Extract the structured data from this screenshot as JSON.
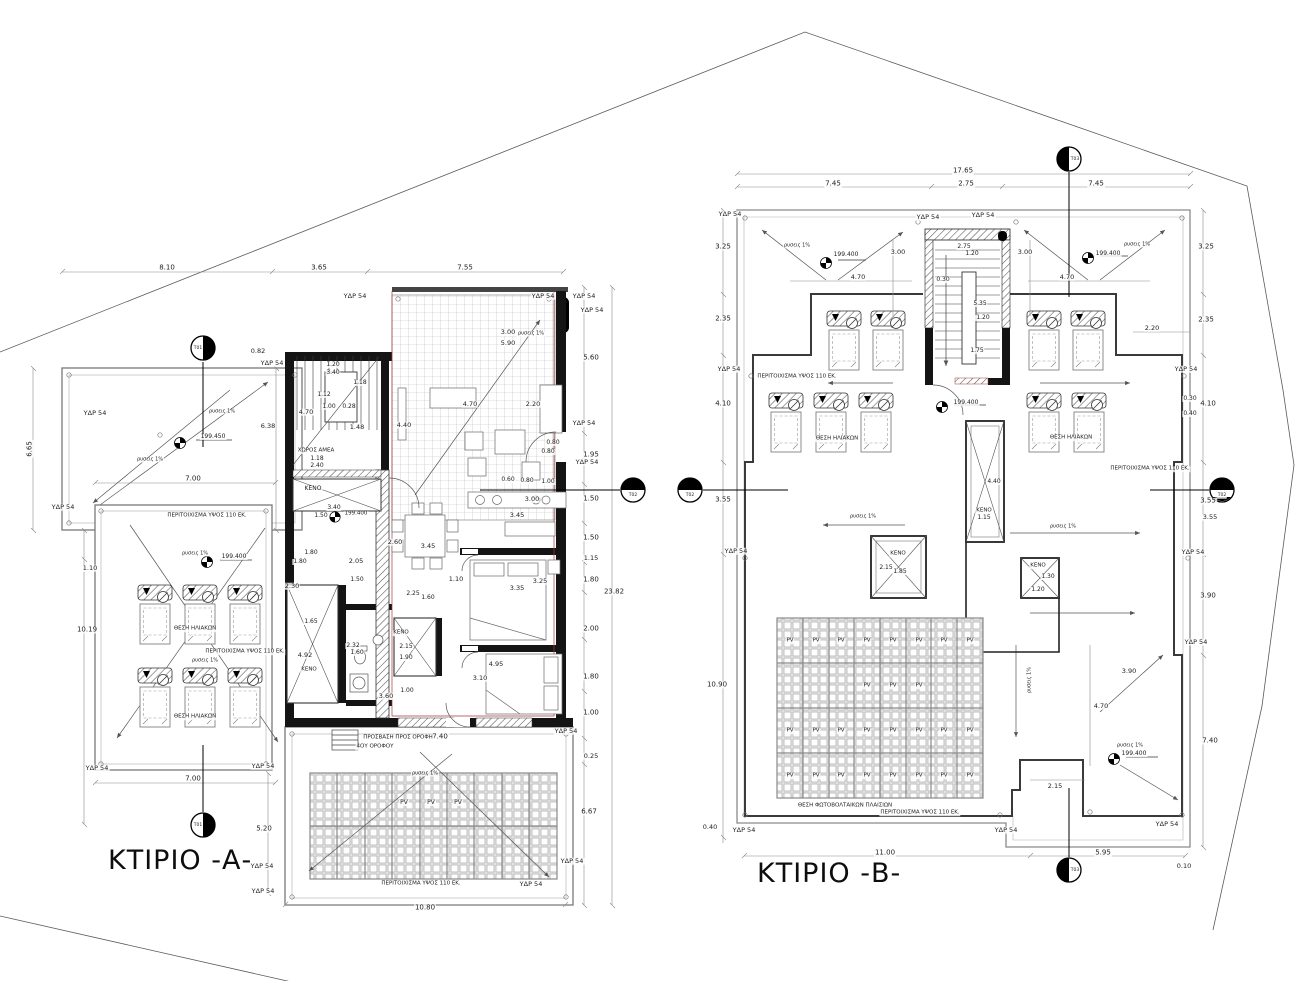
{
  "buildings": {
    "a": {
      "title": "ΚΤΙΡΙΟ -Α-"
    },
    "b": {
      "title": "ΚΤΙΡΙΟ -Β-"
    }
  },
  "colors": {
    "wall": "#141414",
    "red_line": "#a83a3a",
    "dim": "#444444"
  },
  "labels": [
    {
      "t": "8.10",
      "x": 167,
      "y": 268
    },
    {
      "t": "3.65",
      "x": 319,
      "y": 268
    },
    {
      "t": "7.55",
      "x": 465,
      "y": 268
    },
    {
      "t": "ΥΔΡ 54",
      "x": 355,
      "y": 296,
      "s": 6.5
    },
    {
      "t": "ΥΔΡ 54",
      "x": 543,
      "y": 296,
      "s": 6.5
    },
    {
      "t": "ΥΔΡ 54",
      "x": 584,
      "y": 296,
      "s": 6.5
    },
    {
      "t": "ΥΔΡ 54",
      "x": 592,
      "y": 310,
      "s": 6.5
    },
    {
      "t": "ΥΔΡ 54",
      "x": 584,
      "y": 423,
      "s": 6.5
    },
    {
      "t": "ΥΔΡ 54",
      "x": 587,
      "y": 462,
      "s": 6.5
    },
    {
      "t": "3.00",
      "x": 508,
      "y": 332,
      "s": 6.5
    },
    {
      "t": "5.90",
      "x": 508,
      "y": 343,
      "s": 6.5
    },
    {
      "t": "ρυσεις 1%",
      "x": 531,
      "y": 334,
      "s": 5
    },
    {
      "t": "5.60",
      "x": 591,
      "y": 358
    },
    {
      "t": "0.82",
      "x": 258,
      "y": 351,
      "s": 6.5
    },
    {
      "t": "ΥΔΡ 54",
      "x": 272,
      "y": 363,
      "s": 6.5
    },
    {
      "t": "Τ01",
      "x": 198,
      "y": 349,
      "s": 4.5
    },
    {
      "t": "Τ01",
      "x": 198,
      "y": 826,
      "s": 4.5
    },
    {
      "t": "ΥΔΡ 54",
      "x": 95,
      "y": 413,
      "s": 6.5
    },
    {
      "t": "ρυσεις 1%",
      "x": 222,
      "y": 412,
      "s": 5
    },
    {
      "t": "ρυσεις 1%",
      "x": 150,
      "y": 460,
      "s": 5
    },
    {
      "t": "199.450",
      "x": 213,
      "y": 437,
      "s": 6
    },
    {
      "t": "6.65",
      "x": 30,
      "y": 449,
      "r": -90
    },
    {
      "t": "6.38",
      "x": 268,
      "y": 426,
      "s": 6.5
    },
    {
      "t": "7.00",
      "x": 193,
      "y": 479
    },
    {
      "t": "7.00",
      "x": 193,
      "y": 779
    },
    {
      "t": "ΥΔΡ 54",
      "x": 63,
      "y": 507,
      "s": 6.5
    },
    {
      "t": "ΥΔΡ 54",
      "x": 97,
      "y": 768,
      "s": 6.5
    },
    {
      "t": "4.70",
      "x": 306,
      "y": 412,
      "s": 6.5
    },
    {
      "t": "1.12",
      "x": 324,
      "y": 395,
      "s": 6
    },
    {
      "t": "1.00",
      "x": 329,
      "y": 407,
      "s": 6
    },
    {
      "t": "0.28",
      "x": 349,
      "y": 407,
      "s": 6
    },
    {
      "t": "1.48",
      "x": 357,
      "y": 427,
      "s": 6.5
    },
    {
      "t": "1.20",
      "x": 333,
      "y": 365,
      "s": 6
    },
    {
      "t": "3.40",
      "x": 333,
      "y": 373,
      "s": 6
    },
    {
      "t": "1.18",
      "x": 360,
      "y": 383,
      "s": 6
    },
    {
      "t": "ΧΩΡΟΣ ΑΜΕΑ",
      "x": 316,
      "y": 451,
      "s": 5.5
    },
    {
      "t": "1.18",
      "x": 317,
      "y": 459,
      "s": 6
    },
    {
      "t": "2.40",
      "x": 317,
      "y": 466,
      "s": 6
    },
    {
      "t": "ΚΕΝΟ",
      "x": 313,
      "y": 489,
      "s": 6
    },
    {
      "t": "3.40",
      "x": 334,
      "y": 508,
      "s": 6
    },
    {
      "t": "1.50",
      "x": 321,
      "y": 516,
      "s": 6
    },
    {
      "t": "199.400",
      "x": 356,
      "y": 514,
      "s": 5.5
    },
    {
      "t": "4.70",
      "x": 470,
      "y": 404,
      "s": 6.5
    },
    {
      "t": "4.40",
      "x": 404,
      "y": 425,
      "s": 6.5
    },
    {
      "t": "2.20",
      "x": 533,
      "y": 404,
      "s": 6.5
    },
    {
      "t": "0.80",
      "x": 553,
      "y": 443,
      "s": 6
    },
    {
      "t": "0.80",
      "x": 548,
      "y": 452,
      "s": 6
    },
    {
      "t": "1.95",
      "x": 591,
      "y": 455
    },
    {
      "t": "0.60",
      "x": 508,
      "y": 480,
      "s": 6
    },
    {
      "t": "0.80",
      "x": 527,
      "y": 481,
      "s": 6
    },
    {
      "t": "1.00",
      "x": 548,
      "y": 482,
      "s": 6
    },
    {
      "t": "3.00",
      "x": 532,
      "y": 499,
      "s": 6.5
    },
    {
      "t": "1.50",
      "x": 591,
      "y": 499
    },
    {
      "t": "3.45",
      "x": 517,
      "y": 515,
      "s": 6.5
    },
    {
      "t": "3.45",
      "x": 428,
      "y": 546,
      "s": 6.5
    },
    {
      "t": "2.60",
      "x": 395,
      "y": 542,
      "s": 6.5
    },
    {
      "t": "1.80",
      "x": 311,
      "y": 553,
      "s": 6
    },
    {
      "t": "1.80",
      "x": 300,
      "y": 562,
      "s": 6
    },
    {
      "t": "2.05",
      "x": 356,
      "y": 561,
      "s": 6.5
    },
    {
      "t": "2.30",
      "x": 292,
      "y": 586,
      "s": 6.5
    },
    {
      "t": "1.50",
      "x": 357,
      "y": 580,
      "s": 6
    },
    {
      "t": "1.10",
      "x": 456,
      "y": 579,
      "s": 6.5
    },
    {
      "t": "3.35",
      "x": 517,
      "y": 588,
      "s": 6.5
    },
    {
      "t": "3.25",
      "x": 540,
      "y": 581,
      "s": 6.5
    },
    {
      "t": "2.25",
      "x": 413,
      "y": 594,
      "s": 6
    },
    {
      "t": "1.60",
      "x": 428,
      "y": 598,
      "s": 6
    },
    {
      "t": "ΚΕΝΟ",
      "x": 401,
      "y": 633,
      "s": 5.5
    },
    {
      "t": "2.15",
      "x": 406,
      "y": 647,
      "s": 6
    },
    {
      "t": "1.90",
      "x": 406,
      "y": 658,
      "s": 6
    },
    {
      "t": "1.65",
      "x": 311,
      "y": 622,
      "s": 6
    },
    {
      "t": "4.92",
      "x": 305,
      "y": 655,
      "s": 6.5
    },
    {
      "t": "ΚΕΝΟ",
      "x": 309,
      "y": 670,
      "s": 5.5
    },
    {
      "t": "2.32",
      "x": 353,
      "y": 646,
      "s": 6
    },
    {
      "t": "1.60",
      "x": 357,
      "y": 653,
      "s": 6
    },
    {
      "t": "3.60",
      "x": 386,
      "y": 696,
      "s": 6.5
    },
    {
      "t": "1.00",
      "x": 407,
      "y": 691,
      "s": 6
    },
    {
      "t": "4.95",
      "x": 496,
      "y": 664,
      "s": 6.5
    },
    {
      "t": "3.10",
      "x": 480,
      "y": 678,
      "s": 6.5
    },
    {
      "t": "1.50",
      "x": 591,
      "y": 538
    },
    {
      "t": "1.15",
      "x": 591,
      "y": 558,
      "s": 6.5
    },
    {
      "t": "1.80",
      "x": 591,
      "y": 580
    },
    {
      "t": "2.00",
      "x": 591,
      "y": 629
    },
    {
      "t": "1.80",
      "x": 591,
      "y": 677
    },
    {
      "t": "1.00",
      "x": 591,
      "y": 713
    },
    {
      "t": "23.82",
      "x": 614,
      "y": 592
    },
    {
      "t": "0.25",
      "x": 591,
      "y": 756,
      "s": 6.5
    },
    {
      "t": "6.67",
      "x": 589,
      "y": 812
    },
    {
      "t": "ΥΔΡ 54",
      "x": 566,
      "y": 731,
      "s": 6.5
    },
    {
      "t": "7.40",
      "x": 440,
      "y": 737
    },
    {
      "t": "ΠΡΟΣΒΑΣΗ ΠΡΟΣ ΟΡΟΦΗ",
      "x": 398,
      "y": 738,
      "s": 5.5
    },
    {
      "t": "4ΟΥ ΟΡΟΦΟΥ",
      "x": 375,
      "y": 747,
      "s": 5.5
    },
    {
      "t": "ΠΕΡΙΤΟΙΧΙΣΜΑ ΥΨΟΣ 110 ΕΚ.",
      "x": 207,
      "y": 516,
      "s": 5.5
    },
    {
      "t": "ΠΕΡΙΤΟΙΧΙΣΜΑ ΥΨΟΣ 110 ΕΚ.",
      "x": 245,
      "y": 652,
      "s": 5.5
    },
    {
      "t": "ρυσεις 1%",
      "x": 195,
      "y": 554,
      "s": 5
    },
    {
      "t": "ρυσεις 1%",
      "x": 205,
      "y": 661,
      "s": 5
    },
    {
      "t": "199.400",
      "x": 234,
      "y": 557,
      "s": 6
    },
    {
      "t": "ΘΕΣΗ ΗΛΙΑΚΩΝ",
      "x": 195,
      "y": 629,
      "s": 5.5
    },
    {
      "t": "ΘΕΣΗ ΗΛΙΑΚΩΝ",
      "x": 195,
      "y": 717,
      "s": 5.5
    },
    {
      "t": "ΥΔΡ 54",
      "x": 263,
      "y": 766,
      "s": 6.5
    },
    {
      "t": "ΥΔΡ 54",
      "x": 262,
      "y": 866,
      "s": 6.5
    },
    {
      "t": "ΥΔΡ 54",
      "x": 263,
      "y": 891,
      "s": 6.5
    },
    {
      "t": "5.20",
      "x": 264,
      "y": 829
    },
    {
      "t": "1.10",
      "x": 90,
      "y": 568,
      "s": 6.5
    },
    {
      "t": "10.19",
      "x": 87,
      "y": 630
    },
    {
      "t": "ρυσεις 1%",
      "x": 425,
      "y": 774,
      "s": 5
    },
    {
      "t": "PV",
      "x": 404,
      "y": 803,
      "s": 6
    },
    {
      "t": "PV",
      "x": 431,
      "y": 803,
      "s": 6
    },
    {
      "t": "PV",
      "x": 458,
      "y": 803,
      "s": 6
    },
    {
      "t": "ΠΕΡΙΤΟΙΧΙΣΜΑ ΥΨΟΣ 110 ΕΚ.",
      "x": 421,
      "y": 884,
      "s": 5.5
    },
    {
      "t": "ΥΔΡ 54",
      "x": 531,
      "y": 884,
      "s": 6.5
    },
    {
      "t": "ΥΔΡ 54",
      "x": 572,
      "y": 861,
      "s": 6.5
    },
    {
      "t": "10.80",
      "x": 425,
      "y": 908
    },
    {
      "t": "17.65",
      "x": 963,
      "y": 171
    },
    {
      "t": "7.45",
      "x": 833,
      "y": 184
    },
    {
      "t": "2.75",
      "x": 966,
      "y": 184
    },
    {
      "t": "7.45",
      "x": 1096,
      "y": 184
    },
    {
      "t": "Τ03",
      "x": 1075,
      "y": 160,
      "s": 4.5
    },
    {
      "t": "Τ03",
      "x": 1075,
      "y": 871,
      "s": 4.5
    },
    {
      "t": "Τ02",
      "x": 633,
      "y": 496,
      "s": 4.5
    },
    {
      "t": "Τ02",
      "x": 690,
      "y": 496,
      "s": 4.5
    },
    {
      "t": "Τ02",
      "x": 1222,
      "y": 496,
      "s": 4.5
    },
    {
      "t": "ΥΔΡ 54",
      "x": 730,
      "y": 214,
      "s": 6.5
    },
    {
      "t": "ΥΔΡ 54",
      "x": 928,
      "y": 217,
      "s": 6.5
    },
    {
      "t": "ΥΔΡ 54",
      "x": 983,
      "y": 215,
      "s": 6.5
    },
    {
      "t": "ΥΔΡ 54",
      "x": 729,
      "y": 369,
      "s": 6.5
    },
    {
      "t": "ΥΔΡ 54",
      "x": 1186,
      "y": 369,
      "s": 6.5
    },
    {
      "t": "ΥΔΡ 54",
      "x": 736,
      "y": 551,
      "s": 6.5
    },
    {
      "t": "ΥΔΡ 54",
      "x": 1193,
      "y": 552,
      "s": 6.5
    },
    {
      "t": "ΥΔΡ 54",
      "x": 1196,
      "y": 642,
      "s": 6.5
    },
    {
      "t": "ΥΔΡ 54",
      "x": 744,
      "y": 830,
      "s": 6.5
    },
    {
      "t": "ΥΔΡ 54",
      "x": 1006,
      "y": 830,
      "s": 6.5
    },
    {
      "t": "ΥΔΡ 54",
      "x": 1167,
      "y": 824,
      "s": 6.5
    },
    {
      "t": "3.25",
      "x": 723,
      "y": 247
    },
    {
      "t": "2.35",
      "x": 723,
      "y": 319
    },
    {
      "t": "4.10",
      "x": 723,
      "y": 404
    },
    {
      "t": "3.55",
      "x": 723,
      "y": 500
    },
    {
      "t": "10.90",
      "x": 717,
      "y": 685
    },
    {
      "t": "0.40",
      "x": 710,
      "y": 827,
      "s": 6.5
    },
    {
      "t": "3.25",
      "x": 1206,
      "y": 247
    },
    {
      "t": "2.35",
      "x": 1206,
      "y": 320
    },
    {
      "t": "4.10",
      "x": 1208,
      "y": 404
    },
    {
      "t": "3.55",
      "x": 1208,
      "y": 501
    },
    {
      "t": "3.90",
      "x": 1208,
      "y": 596
    },
    {
      "t": "7.40",
      "x": 1210,
      "y": 741
    },
    {
      "t": "2.20",
      "x": 1152,
      "y": 328,
      "s": 6.5
    },
    {
      "t": "0.30",
      "x": 1190,
      "y": 399,
      "s": 6
    },
    {
      "t": "0.40",
      "x": 1190,
      "y": 414,
      "s": 6
    },
    {
      "t": "3.55",
      "x": 1210,
      "y": 517,
      "s": 6.5
    },
    {
      "t": "ρυσεις 1%",
      "x": 797,
      "y": 246,
      "s": 5
    },
    {
      "t": "ρυσεις 1%",
      "x": 1137,
      "y": 245,
      "s": 5
    },
    {
      "t": "199.400",
      "x": 846,
      "y": 255,
      "s": 6
    },
    {
      "t": "199.400",
      "x": 1108,
      "y": 254,
      "s": 6
    },
    {
      "t": "3.00",
      "x": 898,
      "y": 252,
      "s": 6.5
    },
    {
      "t": "3.00",
      "x": 1025,
      "y": 252,
      "s": 6.5
    },
    {
      "t": "4.70",
      "x": 858,
      "y": 277,
      "s": 6.5
    },
    {
      "t": "4.70",
      "x": 1067,
      "y": 277,
      "s": 6.5
    },
    {
      "t": "2.75",
      "x": 964,
      "y": 247,
      "s": 6
    },
    {
      "t": "1.20",
      "x": 972,
      "y": 254,
      "s": 6
    },
    {
      "t": "0.30",
      "x": 943,
      "y": 280,
      "s": 6
    },
    {
      "t": "5.35",
      "x": 980,
      "y": 304,
      "s": 6
    },
    {
      "t": "1.20",
      "x": 983,
      "y": 318,
      "s": 6
    },
    {
      "t": "1.75",
      "x": 977,
      "y": 351,
      "s": 6
    },
    {
      "t": "ΠΕΡΙΤΟΙΧΙΣΜΑ ΥΨΟΣ 110 ΕΚ.",
      "x": 797,
      "y": 377,
      "s": 5.5
    },
    {
      "t": "ΠΕΡΙΤΟΙΧΙΣΜΑ ΥΨΟΣ 110 ΕΚ.",
      "x": 1150,
      "y": 469,
      "s": 5.5
    },
    {
      "t": "ΠΕΡΙΤΟΙΧΙΣΜΑ ΥΨΟΣ 110 ΕΚ.",
      "x": 920,
      "y": 813,
      "s": 5.5
    },
    {
      "t": "ΘΕΣΗ ΗΛΙΑΚΩΝ",
      "x": 837,
      "y": 439,
      "s": 5.5
    },
    {
      "t": "ΘΕΣΗ ΗΛΙΑΚΩΝ",
      "x": 1071,
      "y": 438,
      "s": 5.5
    },
    {
      "t": "199.400",
      "x": 966,
      "y": 403,
      "s": 6
    },
    {
      "t": "ΚΕΝΟ",
      "x": 898,
      "y": 554,
      "s": 5.5
    },
    {
      "t": "2.15",
      "x": 886,
      "y": 568,
      "s": 6
    },
    {
      "t": "1.85",
      "x": 900,
      "y": 572,
      "s": 6
    },
    {
      "t": "ΚΕΝΟ",
      "x": 984,
      "y": 511,
      "s": 5.5
    },
    {
      "t": "1.15",
      "x": 984,
      "y": 518,
      "s": 6
    },
    {
      "t": "4.40",
      "x": 994,
      "y": 482,
      "s": 6
    },
    {
      "t": "ΚΕΝΟ",
      "x": 1038,
      "y": 566,
      "s": 5.5
    },
    {
      "t": "1.30",
      "x": 1048,
      "y": 577,
      "s": 6
    },
    {
      "t": "1.20",
      "x": 1038,
      "y": 590,
      "s": 6
    },
    {
      "t": "ρυσεις 1%",
      "x": 863,
      "y": 517,
      "s": 5
    },
    {
      "t": "ρυσεις 1%",
      "x": 1063,
      "y": 527,
      "s": 5
    },
    {
      "t": "ρυσεις 1%",
      "x": 1030,
      "y": 680,
      "s": 5,
      "r": -90
    },
    {
      "t": "PV",
      "x": 790,
      "y": 641,
      "s": 5.5
    },
    {
      "t": "PV",
      "x": 816,
      "y": 641,
      "s": 5.5
    },
    {
      "t": "PV",
      "x": 841,
      "y": 641,
      "s": 5.5
    },
    {
      "t": "PV",
      "x": 867,
      "y": 641,
      "s": 5.5
    },
    {
      "t": "PV",
      "x": 893,
      "y": 641,
      "s": 5.5
    },
    {
      "t": "PV",
      "x": 919,
      "y": 641,
      "s": 5.5
    },
    {
      "t": "PV",
      "x": 944,
      "y": 641,
      "s": 5.5
    },
    {
      "t": "PV",
      "x": 970,
      "y": 641,
      "s": 5.5
    },
    {
      "t": "PV",
      "x": 867,
      "y": 686,
      "s": 5.5
    },
    {
      "t": "PV",
      "x": 893,
      "y": 686,
      "s": 5.5
    },
    {
      "t": "PV",
      "x": 919,
      "y": 686,
      "s": 5.5
    },
    {
      "t": "PV",
      "x": 790,
      "y": 731,
      "s": 5.5
    },
    {
      "t": "PV",
      "x": 816,
      "y": 731,
      "s": 5.5
    },
    {
      "t": "PV",
      "x": 841,
      "y": 731,
      "s": 5.5
    },
    {
      "t": "PV",
      "x": 867,
      "y": 731,
      "s": 5.5
    },
    {
      "t": "PV",
      "x": 893,
      "y": 731,
      "s": 5.5
    },
    {
      "t": "PV",
      "x": 919,
      "y": 731,
      "s": 5.5
    },
    {
      "t": "PV",
      "x": 944,
      "y": 731,
      "s": 5.5
    },
    {
      "t": "PV",
      "x": 970,
      "y": 731,
      "s": 5.5
    },
    {
      "t": "PV",
      "x": 790,
      "y": 776,
      "s": 5.5
    },
    {
      "t": "PV",
      "x": 816,
      "y": 776,
      "s": 5.5
    },
    {
      "t": "PV",
      "x": 841,
      "y": 776,
      "s": 5.5
    },
    {
      "t": "PV",
      "x": 867,
      "y": 776,
      "s": 5.5
    },
    {
      "t": "PV",
      "x": 893,
      "y": 776,
      "s": 5.5
    },
    {
      "t": "PV",
      "x": 919,
      "y": 776,
      "s": 5.5
    },
    {
      "t": "PV",
      "x": 944,
      "y": 776,
      "s": 5.5
    },
    {
      "t": "PV",
      "x": 970,
      "y": 776,
      "s": 5.5
    },
    {
      "t": "ΘΕΣΗ ΦΩΤΟΒΟΛΤΑΙΚΩΝ ΠΛΑΙΣΙΩΝ",
      "x": 845,
      "y": 806,
      "s": 5.5
    },
    {
      "t": "2.15",
      "x": 1055,
      "y": 786,
      "s": 6.5
    },
    {
      "t": "3.90",
      "x": 1129,
      "y": 671,
      "s": 6.5
    },
    {
      "t": "4.70",
      "x": 1101,
      "y": 706,
      "s": 6.5
    },
    {
      "t": "199.400",
      "x": 1134,
      "y": 754,
      "s": 6
    },
    {
      "t": "ρυσεις 1%",
      "x": 1130,
      "y": 746,
      "s": 5
    },
    {
      "t": "11.00",
      "x": 885,
      "y": 853
    },
    {
      "t": "5.95",
      "x": 1103,
      "y": 853
    },
    {
      "t": "0.10",
      "x": 1184,
      "y": 866,
      "s": 6.5
    }
  ]
}
